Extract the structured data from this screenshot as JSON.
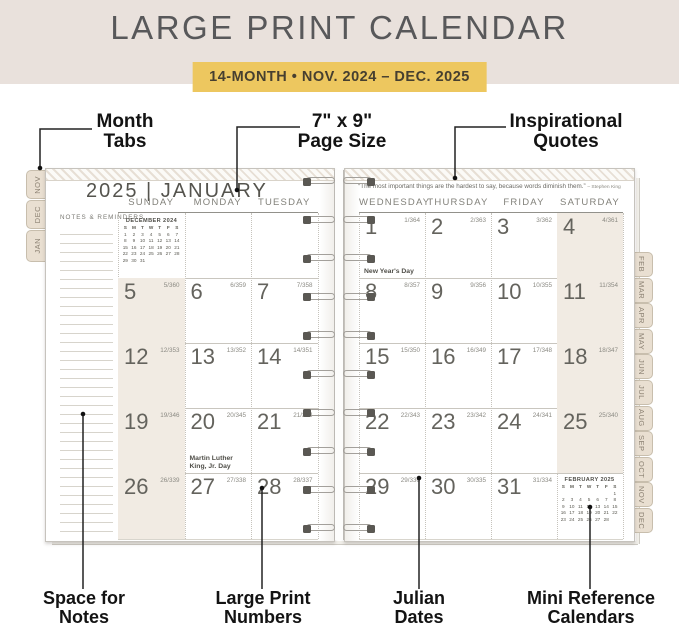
{
  "banner": {
    "title": "LARGE PRINT CALENDAR",
    "subtitle": "14-MONTH  •  NOV. 2024 – DEC. 2025"
  },
  "callouts": {
    "month_tabs": [
      "Month",
      "Tabs"
    ],
    "page_size": [
      "7\" x 9\"",
      "Page Size"
    ],
    "inspirational": [
      "Inspirational",
      "Quotes"
    ],
    "space_notes": [
      "Space for",
      "Notes"
    ],
    "large_print": [
      "Large Print",
      "Numbers"
    ],
    "julian": [
      "Julian",
      "Dates"
    ],
    "mini_ref": [
      "Mini Reference",
      "Calendars"
    ]
  },
  "left_tabs": [
    "NOV",
    "DEC",
    "JAN"
  ],
  "right_tabs": [
    "FEB",
    "MAR",
    "APR",
    "MAY",
    "JUN",
    "JUL",
    "AUG",
    "SEP",
    "OCT",
    "NOV",
    "DEC"
  ],
  "left_page": {
    "title": "2025 | JANUARY",
    "notes_label": "NOTES & REMINDERS",
    "day_headers": [
      "SUNDAY",
      "MONDAY",
      "TUESDAY"
    ],
    "weeks": [
      [
        {
          "mini": "december"
        },
        {},
        {}
      ],
      [
        {
          "day": "5",
          "julian": "5/360"
        },
        {
          "day": "6",
          "julian": "6/359"
        },
        {
          "day": "7",
          "julian": "7/358"
        }
      ],
      [
        {
          "day": "12",
          "julian": "12/353"
        },
        {
          "day": "13",
          "julian": "13/352"
        },
        {
          "day": "14",
          "julian": "14/351"
        }
      ],
      [
        {
          "day": "19",
          "julian": "19/346"
        },
        {
          "day": "20",
          "julian": "20/345",
          "holiday": "Martin Luther King, Jr. Day"
        },
        {
          "day": "21",
          "julian": "21/344"
        }
      ],
      [
        {
          "day": "26",
          "julian": "26/339"
        },
        {
          "day": "27",
          "julian": "27/338"
        },
        {
          "day": "28",
          "julian": "28/337"
        }
      ]
    ]
  },
  "right_page": {
    "quote": "“The most important things are the hardest to say, because words diminish them.”",
    "quote_attribution": "– Stephen King",
    "day_headers": [
      "WEDNESDAY",
      "THURSDAY",
      "FRIDAY",
      "SATURDAY"
    ],
    "weeks": [
      [
        {
          "day": "1",
          "julian": "1/364",
          "holiday": "New Year's Day"
        },
        {
          "day": "2",
          "julian": "2/363"
        },
        {
          "day": "3",
          "julian": "3/362"
        },
        {
          "day": "4",
          "julian": "4/361"
        }
      ],
      [
        {
          "day": "8",
          "julian": "8/357"
        },
        {
          "day": "9",
          "julian": "9/356"
        },
        {
          "day": "10",
          "julian": "10/355"
        },
        {
          "day": "11",
          "julian": "11/354"
        }
      ],
      [
        {
          "day": "15",
          "julian": "15/350"
        },
        {
          "day": "16",
          "julian": "16/349"
        },
        {
          "day": "17",
          "julian": "17/348"
        },
        {
          "day": "18",
          "julian": "18/347"
        }
      ],
      [
        {
          "day": "22",
          "julian": "22/343"
        },
        {
          "day": "23",
          "julian": "23/342"
        },
        {
          "day": "24",
          "julian": "24/341"
        },
        {
          "day": "25",
          "julian": "25/340"
        }
      ],
      [
        {
          "day": "29",
          "julian": "29/336"
        },
        {
          "day": "30",
          "julian": "30/335"
        },
        {
          "day": "31",
          "julian": "31/334"
        },
        {
          "mini": "february"
        }
      ]
    ]
  },
  "mini_calendars": {
    "december": {
      "title": "DECEMBER 2024",
      "day_letters": [
        "S",
        "M",
        "T",
        "W",
        "T",
        "F",
        "S"
      ],
      "weeks": [
        [
          "1",
          "2",
          "3",
          "4",
          "5",
          "6",
          "7"
        ],
        [
          "8",
          "9",
          "10",
          "11",
          "12",
          "13",
          "14"
        ],
        [
          "15",
          "16",
          "17",
          "18",
          "19",
          "20",
          "21"
        ],
        [
          "22",
          "23",
          "24",
          "25",
          "26",
          "27",
          "28"
        ],
        [
          "29",
          "30",
          "31",
          "",
          "",
          "",
          ""
        ]
      ]
    },
    "february": {
      "title": "FEBRUARY 2025",
      "day_letters": [
        "S",
        "M",
        "T",
        "W",
        "T",
        "F",
        "S"
      ],
      "weeks": [
        [
          "",
          "",
          "",
          "",
          "",
          "",
          "1"
        ],
        [
          "2",
          "3",
          "4",
          "5",
          "6",
          "7",
          "8"
        ],
        [
          "9",
          "10",
          "11",
          "12",
          "13",
          "14",
          "15"
        ],
        [
          "16",
          "17",
          "18",
          "19",
          "20",
          "21",
          "22"
        ],
        [
          "23",
          "24",
          "25",
          "26",
          "27",
          "28",
          ""
        ]
      ]
    }
  },
  "colors": {
    "banner_bg": "#e9e1dc",
    "subtitle_bg": "#edc75f",
    "weekend_shade": "#f1ebe3",
    "tab_bg": "#e9dfd1"
  }
}
